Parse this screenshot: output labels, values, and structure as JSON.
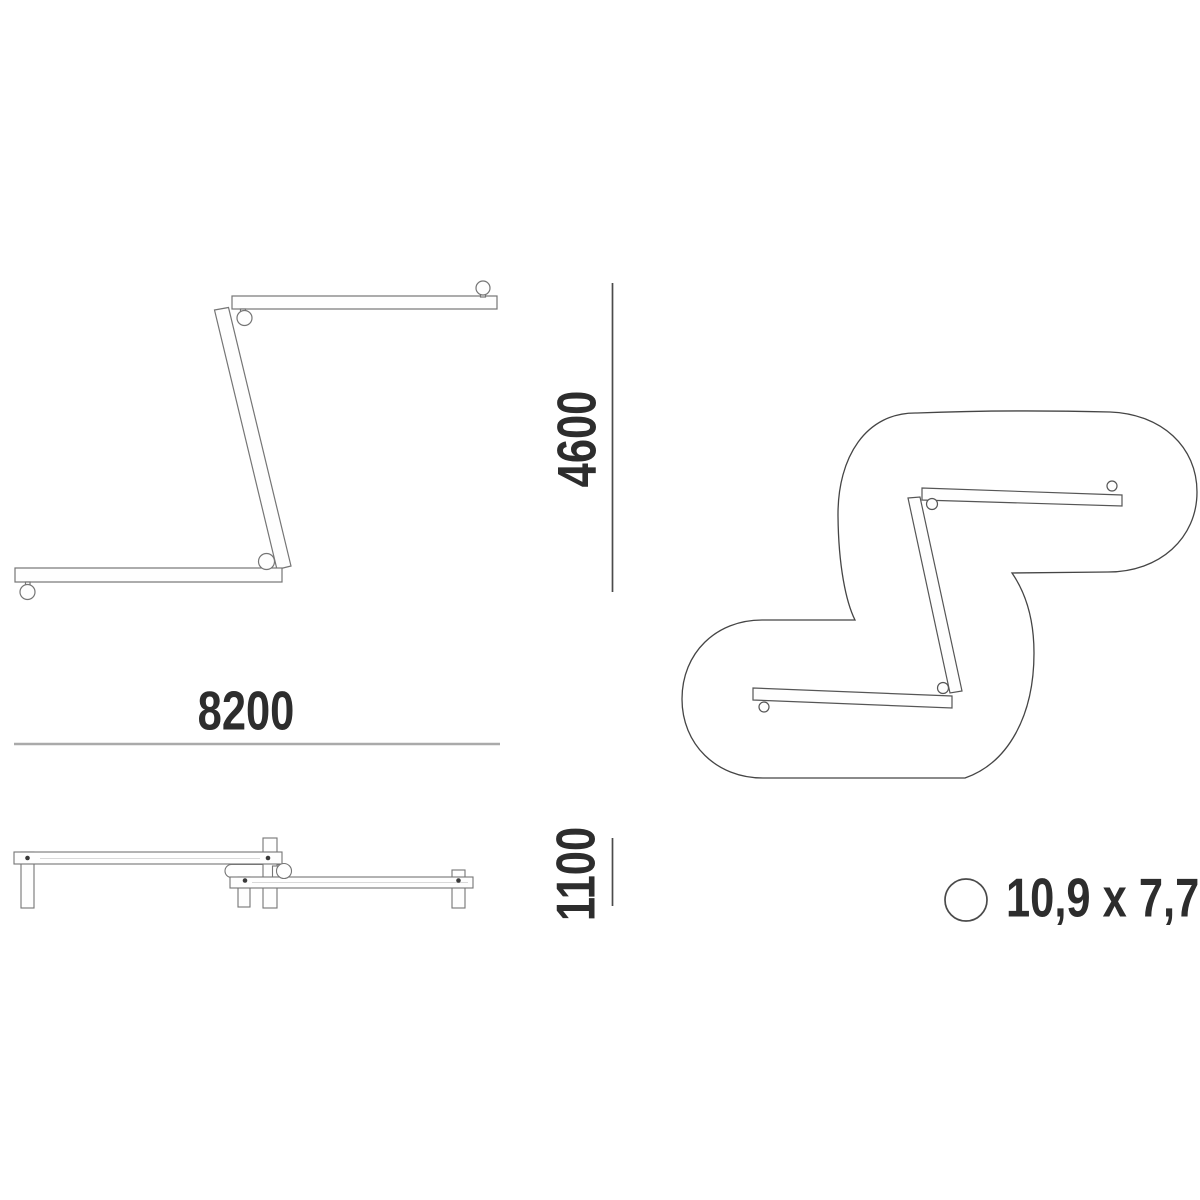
{
  "dimensions": {
    "width": "8200",
    "height": "4600",
    "depth": "1100",
    "profile_size": "10,9 x 7,7"
  },
  "icons": {
    "profile_circle": "circle-outline"
  },
  "colors": {
    "background": "#ffffff",
    "text": "#2d2d2d",
    "dim_line_dark": "#4b4b4b",
    "dim_line_light": "#aaaaaa",
    "fixture_outline": "#757575",
    "plan_outline": "#454545",
    "screw_dot": "#3a3a3a"
  }
}
